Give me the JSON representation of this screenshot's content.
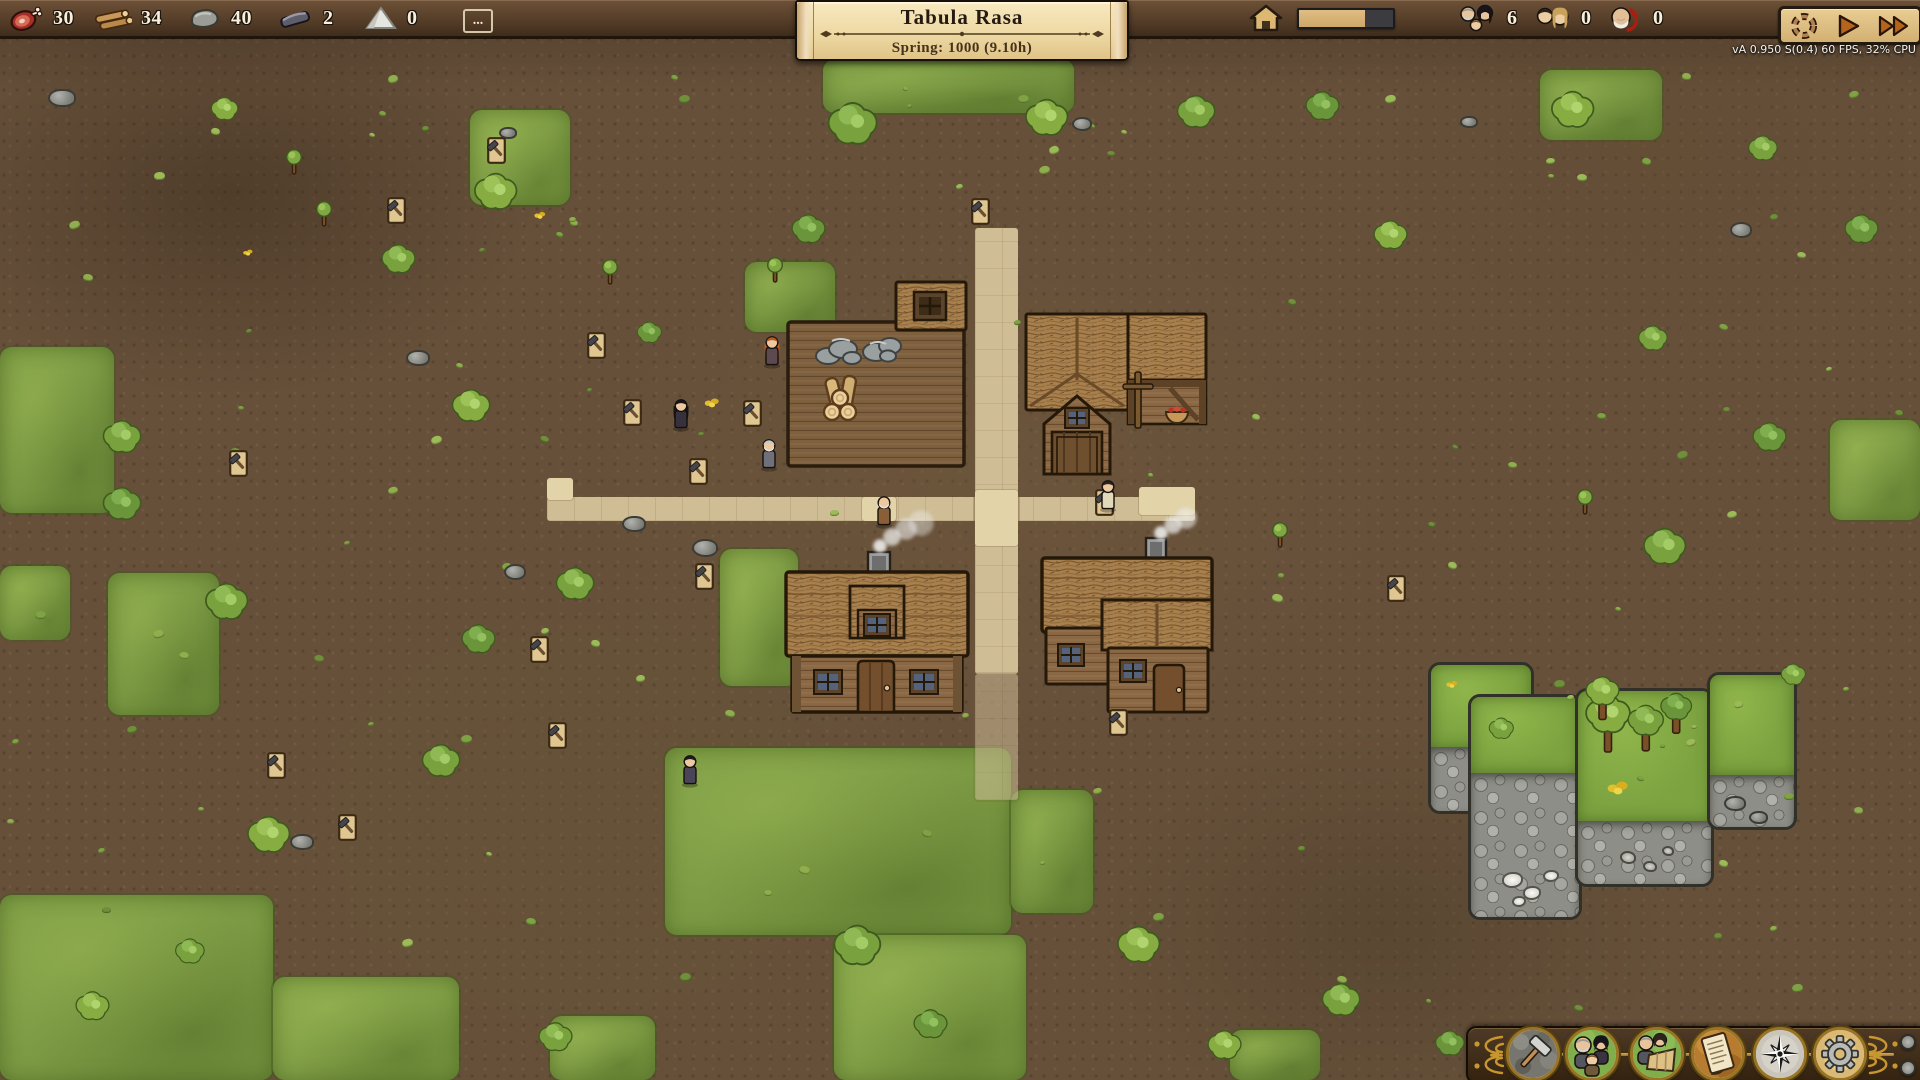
{
  "window": {
    "width": 1920,
    "height": 1080
  },
  "topbar": {
    "resources": [
      {
        "icon": "meat-icon",
        "value": "30"
      },
      {
        "icon": "logs-icon",
        "value": "34"
      },
      {
        "icon": "stone-icon",
        "value": "40"
      },
      {
        "icon": "iron-icon",
        "value": "2"
      },
      {
        "icon": "sand-icon",
        "value": "0"
      }
    ],
    "more_label": "...",
    "housing": {
      "icon": "house-icon",
      "progress_percent": 70
    },
    "population": [
      {
        "icon": "family-icon",
        "value": "6"
      },
      {
        "icon": "couple-icon",
        "value": "0"
      },
      {
        "icon": "elder-ban-icon",
        "value": "0"
      }
    ],
    "playback": [
      {
        "name": "pause-button",
        "icon": "cycle-icon"
      },
      {
        "name": "play-button",
        "icon": "play-icon"
      },
      {
        "name": "fast-forward-button",
        "icon": "fast-forward-icon"
      }
    ]
  },
  "banner": {
    "title": "Tabula Rasa",
    "subtitle": "Spring: 1000  (9.10h)"
  },
  "status": {
    "version_text": "vA 0.950 S(0.4) 60 FPS, 32% CPU"
  },
  "toolbar": {
    "buttons": [
      {
        "name": "build-menu-button",
        "icon": "hammer-icon"
      },
      {
        "name": "villagers-button",
        "icon": "villagers-icon"
      },
      {
        "name": "professions-button",
        "icon": "professions-icon"
      },
      {
        "name": "journal-button",
        "icon": "journal-icon"
      },
      {
        "name": "navigation-button",
        "icon": "compass-icon"
      },
      {
        "name": "settings-button",
        "icon": "gear-icon"
      }
    ],
    "side_buttons": [
      {
        "name": "panel-toggle-top-button"
      },
      {
        "name": "panel-toggle-bottom-button"
      }
    ]
  },
  "map": {
    "colors": {
      "dirt": "#66503a",
      "grass": "#7c9a44",
      "path": "#cfbd96",
      "stone": "#8e8e88",
      "thatch": "#a8804e",
      "wood": "#8a6845"
    },
    "grass_patches": [
      [
        823,
        59,
        251,
        54,
        0
      ],
      [
        470,
        110,
        100,
        95,
        1
      ],
      [
        1540,
        70,
        122,
        70,
        0
      ],
      [
        0,
        347,
        114,
        166,
        0
      ],
      [
        0,
        566,
        70,
        74,
        1
      ],
      [
        108,
        573,
        111,
        142,
        0
      ],
      [
        0,
        895,
        273,
        185,
        0
      ],
      [
        273,
        977,
        186,
        103,
        1
      ],
      [
        665,
        748,
        346,
        187,
        0
      ],
      [
        834,
        935,
        192,
        145,
        1
      ],
      [
        1011,
        790,
        82,
        123,
        0
      ],
      [
        720,
        549,
        78,
        137,
        1
      ],
      [
        745,
        262,
        90,
        70,
        0
      ],
      [
        1830,
        420,
        90,
        100,
        1
      ],
      [
        1230,
        1030,
        90,
        50,
        0
      ],
      [
        550,
        1016,
        105,
        64,
        1
      ]
    ],
    "paths": [
      [
        547,
        497,
        648,
        24
      ],
      [
        975,
        228,
        43,
        446
      ]
    ],
    "paths_faded": [
      [
        975,
        674,
        43,
        126
      ]
    ],
    "paths_bright": [
      [
        975,
        490,
        43,
        56
      ],
      [
        1139,
        487,
        56,
        28
      ],
      [
        547,
        478,
        26,
        22
      ],
      [
        862,
        497,
        34,
        24
      ]
    ],
    "quarry_pieces": [
      [
        1428,
        662,
        100,
        146,
        82
      ],
      [
        1468,
        694,
        108,
        220,
        76
      ],
      [
        1575,
        688,
        133,
        193,
        130
      ],
      [
        1707,
        672,
        84,
        152,
        100
      ]
    ],
    "minerals": [
      [
        1502,
        872,
        17
      ],
      [
        1523,
        886,
        14
      ],
      [
        1543,
        870,
        12
      ],
      [
        1512,
        896,
        10
      ]
    ],
    "debris": [
      [
        1620,
        851,
        12
      ],
      [
        1643,
        861,
        10
      ],
      [
        1662,
        846,
        8
      ]
    ],
    "quarry_rocks": [
      [
        1724,
        796,
        18
      ],
      [
        1749,
        811,
        15
      ]
    ],
    "trees": [
      [
        853,
        122,
        22,
        0,
        0
      ],
      [
        1047,
        116,
        19,
        1,
        0
      ],
      [
        1196,
        110,
        17,
        0,
        0
      ],
      [
        1322,
        104,
        15,
        2,
        0
      ],
      [
        1573,
        108,
        19,
        1,
        0
      ],
      [
        1763,
        147,
        13,
        0,
        0
      ],
      [
        1861,
        227,
        15,
        2,
        0
      ],
      [
        496,
        190,
        19,
        1,
        0
      ],
      [
        398,
        257,
        15,
        0,
        0
      ],
      [
        808,
        227,
        15,
        2,
        0
      ],
      [
        122,
        435,
        17,
        0,
        0
      ],
      [
        122,
        502,
        17,
        2,
        0
      ],
      [
        227,
        600,
        19,
        0,
        0
      ],
      [
        471,
        404,
        17,
        1,
        0
      ],
      [
        575,
        582,
        17,
        0,
        0
      ],
      [
        478,
        637,
        15,
        2,
        0
      ],
      [
        441,
        759,
        17,
        0,
        0
      ],
      [
        269,
        833,
        19,
        1,
        0
      ],
      [
        857,
        943,
        21,
        0,
        0
      ],
      [
        1139,
        943,
        19,
        1,
        0
      ],
      [
        930,
        1022,
        15,
        2,
        0
      ],
      [
        1341,
        998,
        17,
        0,
        0
      ],
      [
        1224,
        1043,
        15,
        1,
        0
      ],
      [
        1665,
        545,
        19,
        0,
        0
      ],
      [
        1769,
        435,
        15,
        2,
        0
      ],
      [
        1653,
        337,
        13,
        0,
        0
      ],
      [
        1390,
        233,
        15,
        1,
        0
      ],
      [
        649,
        331,
        11,
        2,
        0
      ],
      [
        1793,
        673,
        11,
        0,
        0
      ],
      [
        225,
        108,
        12,
        1,
        0
      ],
      [
        555,
        1035,
        15,
        0,
        0
      ],
      [
        1450,
        1042,
        13,
        2,
        0
      ],
      [
        92,
        1004,
        15,
        1,
        0
      ],
      [
        190,
        950,
        13,
        0,
        0
      ],
      [
        1608,
        722,
        20,
        1,
        1
      ],
      [
        1646,
        727,
        16,
        0,
        1
      ],
      [
        1602,
        697,
        15,
        1,
        1
      ],
      [
        1676,
        712,
        14,
        2,
        1
      ],
      [
        1501,
        727,
        11,
        0,
        0
      ]
    ],
    "saplings": [
      [
        294,
        162
      ],
      [
        324,
        214
      ],
      [
        1585,
        502
      ],
      [
        775,
        270
      ],
      [
        1280,
        535
      ],
      [
        610,
        272
      ]
    ],
    "rocks": [
      [
        60,
        96,
        24
      ],
      [
        416,
        356,
        20
      ],
      [
        513,
        570,
        18
      ],
      [
        632,
        522,
        20
      ],
      [
        703,
        546,
        22
      ],
      [
        300,
        840,
        20
      ],
      [
        1739,
        228,
        18
      ],
      [
        1080,
        122,
        16
      ],
      [
        506,
        131,
        14
      ],
      [
        1467,
        120,
        14
      ]
    ],
    "signs": [
      [
        496,
        150
      ],
      [
        396,
        210
      ],
      [
        980,
        211
      ],
      [
        596,
        345
      ],
      [
        632,
        412
      ],
      [
        752,
        413
      ],
      [
        698,
        471
      ],
      [
        704,
        576
      ],
      [
        539,
        649
      ],
      [
        557,
        735
      ],
      [
        276,
        765
      ],
      [
        347,
        827
      ],
      [
        1104,
        502
      ],
      [
        1396,
        588
      ],
      [
        1118,
        722
      ],
      [
        238,
        463
      ]
    ],
    "flowers": [
      [
        540,
        215,
        14
      ],
      [
        712,
        402,
        18
      ],
      [
        248,
        252,
        12
      ],
      [
        1452,
        684,
        14
      ],
      [
        1618,
        787,
        26
      ]
    ],
    "villagers": [
      {
        "x": 772,
        "y": 352,
        "hair": "#b55a22",
        "dress": "#5c4a50",
        "longhair": true
      },
      {
        "x": 681,
        "y": 415,
        "hair": "#17141a",
        "dress": "#37313d",
        "longhair": true
      },
      {
        "x": 769,
        "y": 455,
        "hair": "#c9c9c9",
        "dress": "#70707a",
        "beard": true
      },
      {
        "x": 884,
        "y": 512,
        "hair": "#e6e2d6",
        "dress": "#8a5f38",
        "beard": true,
        "bald": true
      },
      {
        "x": 1108,
        "y": 496,
        "hair": "#2a241e",
        "dress": "#e2d8ba"
      },
      {
        "x": 690,
        "y": 771,
        "hair": "#1c1c1c",
        "dress": "#4a4458"
      }
    ],
    "buildings": [
      {
        "type": "storage",
        "x": 780,
        "y": 278,
        "w": 192,
        "h": 194
      },
      {
        "type": "barn",
        "x": 1020,
        "y": 308,
        "w": 192,
        "h": 168
      },
      {
        "type": "cottage",
        "x": 780,
        "y": 536,
        "w": 194,
        "h": 180
      },
      {
        "type": "cottage2",
        "x": 1036,
        "y": 528,
        "w": 182,
        "h": 188
      }
    ],
    "smoke": [
      [
        880,
        546,
        7
      ],
      [
        892,
        537,
        9
      ],
      [
        906,
        529,
        11
      ],
      [
        921,
        523,
        13
      ],
      [
        1161,
        533,
        7
      ],
      [
        1173,
        525,
        9
      ],
      [
        1186,
        518,
        11
      ]
    ]
  }
}
